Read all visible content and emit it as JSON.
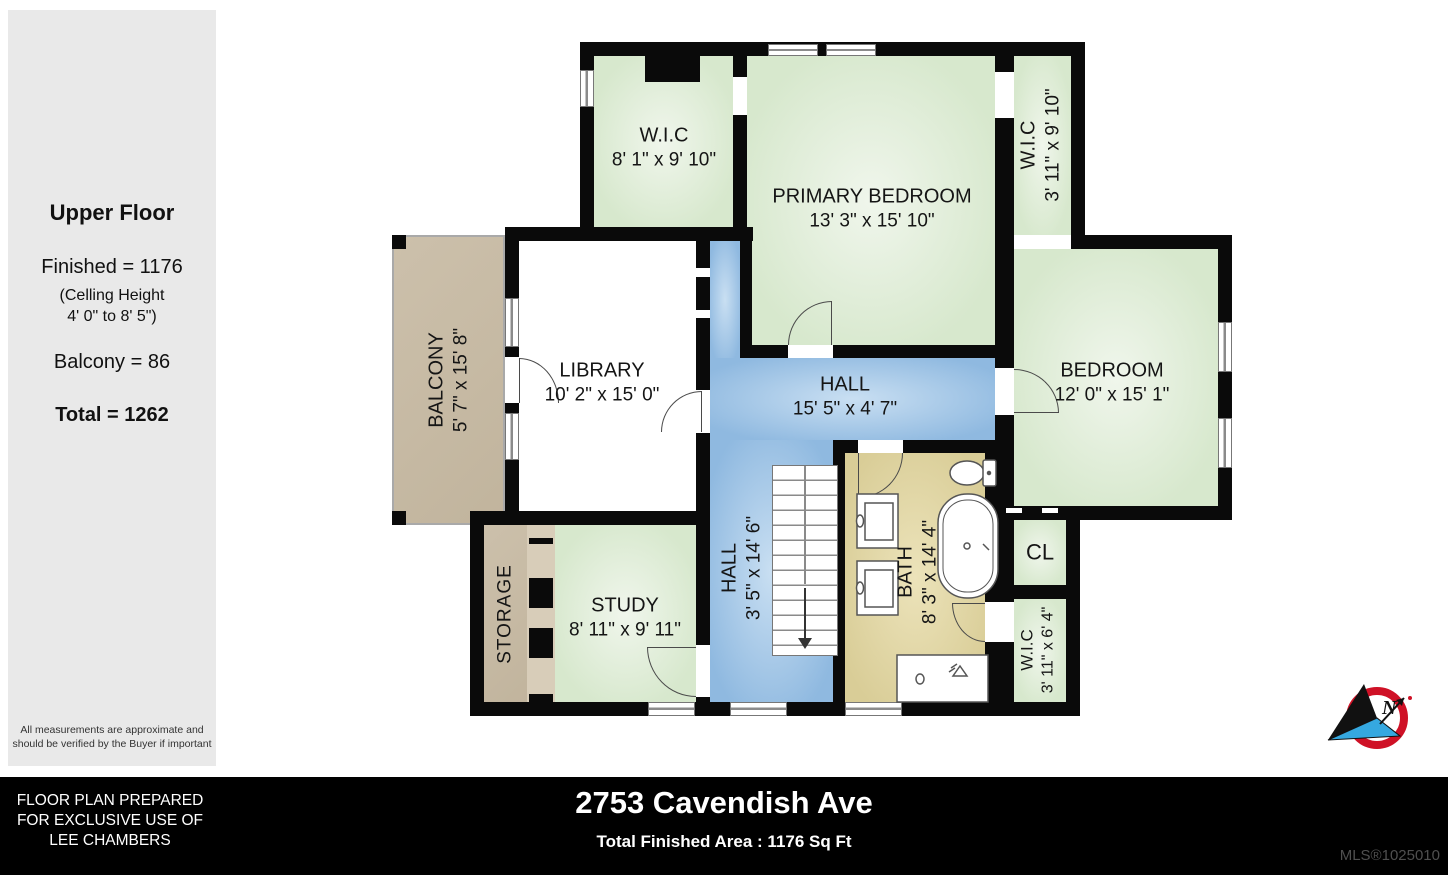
{
  "sidebar": {
    "title": "Upper Floor",
    "finished": "Finished = 1176",
    "ceiling_line1": "(Celling Height",
    "ceiling_line2": "4' 0\" to 8' 5\")",
    "balcony": "Balcony = 86",
    "total": "Total = 1262",
    "disclaimer_line1": "All measurements are approximate and",
    "disclaimer_line2": "should be verified by the Buyer if important"
  },
  "rooms": {
    "wic_top_left": {
      "name": "W.I.C",
      "dims": "8' 1\" x 9' 10\""
    },
    "primary": {
      "name": "PRIMARY BEDROOM",
      "dims": "13' 3\" x 15' 10\""
    },
    "wic_top_right": {
      "name": "W.I.C",
      "dims": "3' 11\" x 9' 10\""
    },
    "bedroom": {
      "name": "BEDROOM",
      "dims": "12' 0\" x 15' 1\""
    },
    "library": {
      "name": "LIBRARY",
      "dims": "10' 2\" x 15' 0\""
    },
    "hall": {
      "name": "HALL",
      "dims": "15' 5\" x 4' 7\""
    },
    "hall_stairs": {
      "name": "HALL",
      "dims": "3' 5\" x 14' 6\""
    },
    "bath": {
      "name": "BATH",
      "dims": "8' 3\" x 14' 4\""
    },
    "closet": {
      "name": "CL"
    },
    "wic_bottom": {
      "name": "W.I.C",
      "dims": "3' 11\" x 6' 4\""
    },
    "balcony": {
      "name": "BALCONY",
      "dims": "5' 7\" x 15' 8\""
    },
    "storage": {
      "name": "STORAGE"
    },
    "study": {
      "name": "STUDY",
      "dims": "8' 11\" x 9' 11\""
    }
  },
  "footer": {
    "prepared_line1": "FLOOR PLAN PREPARED",
    "prepared_line2": "FOR EXCLUSIVE USE OF",
    "prepared_line3": "LEE CHAMBERS",
    "address": "2753 Cavendish Ave",
    "total_area": "Total Finished Area : 1176 Sq Ft",
    "mls": "MLS®1025010"
  },
  "compass": {
    "label": "N"
  },
  "colors": {
    "room_green": "#d7e8cd",
    "room_blue": "#8fb9e0",
    "bath_khaki": "#d9cd97",
    "balcony_tan": "#c6b9a2",
    "wall_black": "#0a0a0a",
    "compass_red": "#cf1126",
    "compass_blue": "#35a8e0"
  }
}
